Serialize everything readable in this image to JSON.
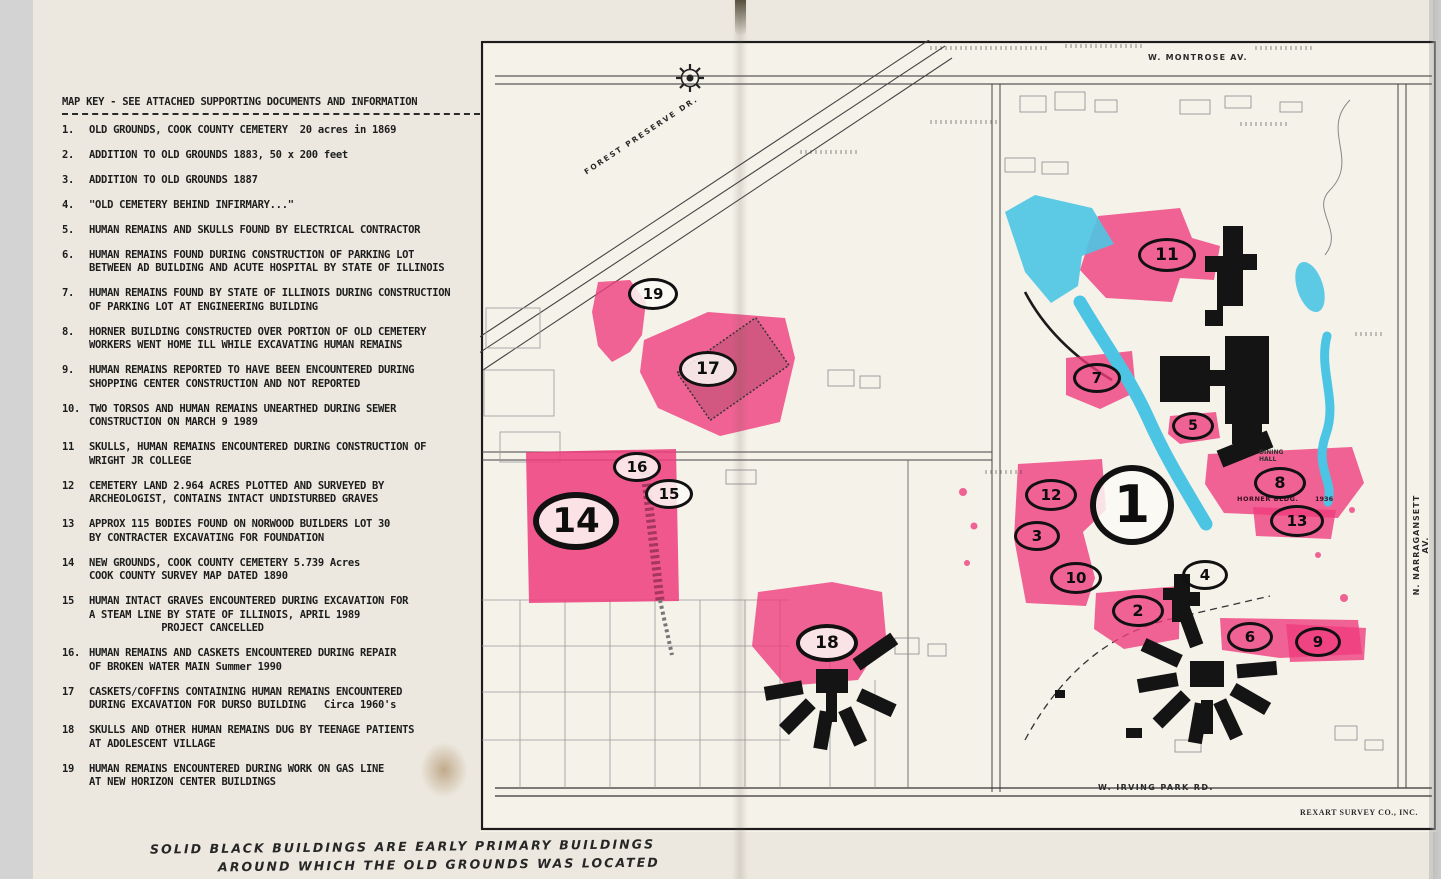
{
  "key": {
    "title": "MAP KEY - SEE ATTACHED SUPPORTING DOCUMENTS AND INFORMATION",
    "items": [
      {
        "num": "1.",
        "text": "OLD GROUNDS, COOK COUNTY CEMETERY  20 acres in 1869"
      },
      {
        "num": "2.",
        "text": "ADDITION TO OLD GROUNDS 1883, 50 x 200 feet"
      },
      {
        "num": "3.",
        "text": "ADDITION TO OLD GROUNDS 1887"
      },
      {
        "num": "4.",
        "text": "\"OLD CEMETERY BEHIND INFIRMARY...\""
      },
      {
        "num": "5.",
        "text": "HUMAN REMAINS AND SKULLS FOUND BY ELECTRICAL CONTRACTOR"
      },
      {
        "num": "6.",
        "text": "HUMAN REMAINS FOUND DURING CONSTRUCTION OF PARKING LOT\nBETWEEN AD BUILDING AND ACUTE HOSPITAL BY STATE OF ILLINOIS"
      },
      {
        "num": "7.",
        "text": "HUMAN REMAINS FOUND BY STATE OF ILLINOIS DURING CONSTRUCTION\nOF PARKING LOT AT ENGINEERING BUILDING"
      },
      {
        "num": "8.",
        "text": "HORNER BUILDING CONSTRUCTED OVER PORTION OF OLD CEMETERY\nWORKERS WENT HOME ILL WHILE EXCAVATING HUMAN REMAINS"
      },
      {
        "num": "9.",
        "text": "HUMAN REMAINS REPORTED TO HAVE BEEN ENCOUNTERED DURING\nSHOPPING CENTER CONSTRUCTION AND NOT REPORTED"
      },
      {
        "num": "10.",
        "text": "TWO TORSOS AND HUMAN REMAINS UNEARTHED DURING SEWER\nCONSTRUCTION ON MARCH 9 1989"
      },
      {
        "num": "11",
        "text": "SKULLS, HUMAN REMAINS ENCOUNTERED DURING CONSTRUCTION OF\nWRIGHT JR COLLEGE"
      },
      {
        "num": "12",
        "text": "CEMETERY LAND 2.964 ACRES PLOTTED AND SURVEYED BY\nARCHEOLOGIST, CONTAINS INTACT UNDISTURBED GRAVES"
      },
      {
        "num": "13",
        "text": "APPROX 115 BODIES FOUND ON NORWOOD BUILDERS LOT 30\nBY CONTRACTER EXCAVATING FOR FOUNDATION"
      },
      {
        "num": "14",
        "text": "NEW GROUNDS, COOK COUNTY CEMETERY 5.739 Acres\nCOOK COUNTY SURVEY MAP DATED 1890"
      },
      {
        "num": "15",
        "text": "HUMAN INTACT GRAVES ENCOUNTERED DURING EXCAVATION FOR\nA STEAM LINE BY STATE OF ILLINOIS, APRIL 1989\n            PROJECT CANCELLED"
      },
      {
        "num": "16.",
        "text": "HUMAN REMAINS AND CASKETS ENCOUNTERED DURING REPAIR\nOF BROKEN WATER MAIN Summer 1990"
      },
      {
        "num": "17",
        "text": "CASKETS/COFFINS CONTAINING HUMAN REMAINS ENCOUNTERED\nDURING EXCAVATION FOR DURSO BUILDING   Circa 1960's"
      },
      {
        "num": "18",
        "text": "SKULLS AND OTHER HUMAN REMAINS DUG BY TEENAGE PATIENTS\nAT ADOLESCENT VILLAGE"
      },
      {
        "num": "19",
        "text": "HUMAN REMAINS ENCOUNTERED DURING WORK ON GAS LINE\nAT NEW HORIZON CENTER BUILDINGS"
      }
    ]
  },
  "note": {
    "line1": "SOLID BLACK BUILDINGS ARE EARLY PRIMARY BUILDINGS",
    "line2": "AROUND WHICH THE OLD GROUNDS WAS LOCATED"
  },
  "map": {
    "street_labels": {
      "montrose": "W. MONTROSE AV.",
      "forest_preserve": "FOREST PRESERVE DR.",
      "narragansett": "N. NARRAGANSETT AV.",
      "irving_park": "W. IRVING PARK RD.",
      "attribution": "REXART SURVEY CO., INC.",
      "horner_bldg": "HORNER BLDG.",
      "horner_year": "1936",
      "dining_hall": "DINING\nHALL"
    },
    "colors": {
      "highlight_pink": "#ef3d7d",
      "water_blue": "#4cc5e4",
      "building_black": "#141414",
      "paper": "#ece8df"
    },
    "markers": [
      {
        "label": "19",
        "x": 653,
        "y": 294,
        "w": 50,
        "h": 32,
        "fs": 15,
        "bw": 3,
        "fill": "white"
      },
      {
        "label": "17",
        "x": 708,
        "y": 369,
        "w": 58,
        "h": 36,
        "fs": 17,
        "bw": 3,
        "fill": "white"
      },
      {
        "label": "16",
        "x": 637,
        "y": 467,
        "w": 48,
        "h": 30,
        "fs": 15,
        "bw": 3,
        "fill": "white"
      },
      {
        "label": "15",
        "x": 669,
        "y": 494,
        "w": 48,
        "h": 30,
        "fs": 15,
        "bw": 3,
        "fill": "white"
      },
      {
        "label": "14",
        "x": 576,
        "y": 521,
        "w": 86,
        "h": 58,
        "fs": 34,
        "bw": 6,
        "fill": "white"
      },
      {
        "label": "18",
        "x": 827,
        "y": 643,
        "w": 62,
        "h": 38,
        "fs": 17,
        "bw": 4,
        "fill": "white"
      },
      {
        "label": "11",
        "x": 1167,
        "y": 255,
        "w": 58,
        "h": 34,
        "fs": 17,
        "bw": 3,
        "fill": "none"
      },
      {
        "label": "7",
        "x": 1097,
        "y": 378,
        "w": 48,
        "h": 30,
        "fs": 15,
        "bw": 3,
        "fill": "none"
      },
      {
        "label": "5",
        "x": 1193,
        "y": 426,
        "w": 42,
        "h": 28,
        "fs": 14,
        "bw": 3,
        "fill": "none"
      },
      {
        "label": "12",
        "x": 1051,
        "y": 495,
        "w": 52,
        "h": 32,
        "fs": 15,
        "bw": 3,
        "fill": "none"
      },
      {
        "label": "1",
        "x": 1132,
        "y": 505,
        "w": 84,
        "h": 80,
        "fs": 52,
        "bw": 6,
        "fill": "white"
      },
      {
        "label": "3",
        "x": 1037,
        "y": 536,
        "w": 46,
        "h": 30,
        "fs": 15,
        "bw": 3,
        "fill": "none"
      },
      {
        "label": "10",
        "x": 1076,
        "y": 578,
        "w": 52,
        "h": 32,
        "fs": 15,
        "bw": 3,
        "fill": "none"
      },
      {
        "label": "2",
        "x": 1138,
        "y": 611,
        "w": 52,
        "h": 32,
        "fs": 16,
        "bw": 3,
        "fill": "none"
      },
      {
        "label": "4",
        "x": 1205,
        "y": 575,
        "w": 46,
        "h": 30,
        "fs": 15,
        "bw": 3,
        "fill": "none"
      },
      {
        "label": "8",
        "x": 1280,
        "y": 483,
        "w": 52,
        "h": 32,
        "fs": 16,
        "bw": 3,
        "fill": "none"
      },
      {
        "label": "13",
        "x": 1297,
        "y": 521,
        "w": 54,
        "h": 32,
        "fs": 15,
        "bw": 3,
        "fill": "none"
      },
      {
        "label": "6",
        "x": 1250,
        "y": 637,
        "w": 46,
        "h": 30,
        "fs": 15,
        "bw": 3,
        "fill": "none"
      },
      {
        "label": "9",
        "x": 1318,
        "y": 642,
        "w": 46,
        "h": 30,
        "fs": 15,
        "bw": 3,
        "fill": "none"
      }
    ]
  }
}
